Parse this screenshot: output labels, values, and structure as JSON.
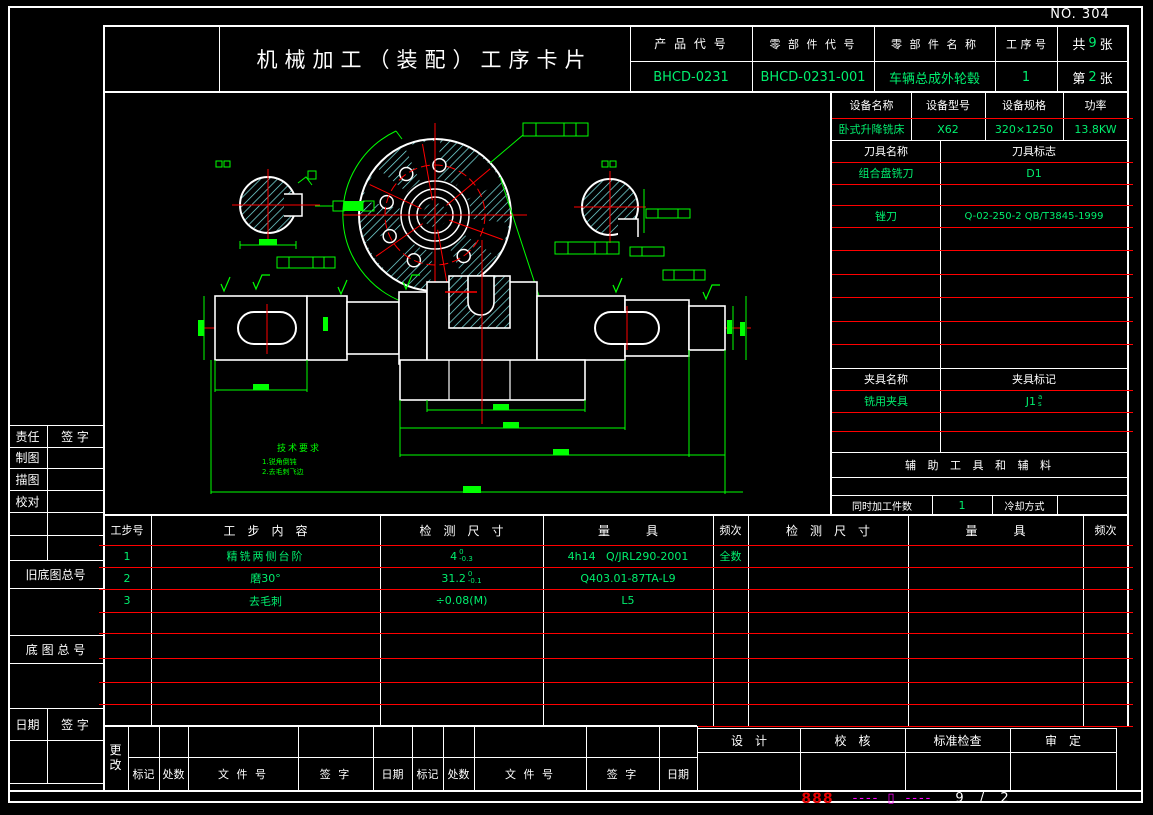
{
  "page": {
    "no": "NO. 304",
    "footer": {
      "code": "888",
      "dash_l": "----",
      "sym": "▯",
      "dash_r": "----",
      "sheet_ratio": "9 / 2"
    }
  },
  "header": {
    "title": "机械加工（装配）工序卡片",
    "product_code_label": "产 品 代 号",
    "part_code_label": "零 部 件 代 号",
    "part_name_label": "零 部 件 名 称",
    "process_no_label": "工 序 号",
    "total_prefix": "共",
    "total_pages": "9",
    "total_suffix": "张",
    "sheet_prefix": "第",
    "sheet_no": "2",
    "sheet_suffix": "张",
    "product_code": "BHCD-0231",
    "part_code": "BHCD-0231-001",
    "part_name": "车辆总成外轮毂",
    "process_no": "1"
  },
  "equipment": {
    "name_label": "设备名称",
    "model_label": "设备型号",
    "spec_label": "设备规格",
    "power_label": "功率",
    "name": "卧式升降铣床",
    "model": "X62",
    "spec": "320×1250",
    "power": "13.8KW"
  },
  "tools": {
    "name_label": "刀具名称",
    "mark_label": "刀具标志",
    "row1_name": "组合盘铣刀",
    "row1_mark": "D1",
    "row2_name": "锉刀",
    "row2_mark": "Q-02-250-2 QB/T3845-1999"
  },
  "fixtures": {
    "name_label": "夹具名称",
    "mark_label": "夹具标记",
    "name": "铣用夹具",
    "mark": "J1",
    "mark_sup": "a",
    "mark_sub": "s"
  },
  "aux_header": "辅 助 工 具 和 辅 料",
  "simul": {
    "label": "同时加工件数",
    "value": "1",
    "cooling_label": "冷却方式",
    "cooling_value": ""
  },
  "process": {
    "h_step_no": "工步号",
    "h_content": "工　步　内　容",
    "h_dim": "检　测　尺　寸",
    "h_gauge": "量　　　具",
    "h_freq": "频次",
    "rows": [
      {
        "no": "1",
        "content": "精铣两侧台阶",
        "dim": "4",
        "sup": "0",
        "sub": "-0.3",
        "gauge": "4h14   Q/JRL290-2001",
        "freq": "全数"
      },
      {
        "no": "2",
        "content": "磨30°",
        "dim": "31.2",
        "sup": "0",
        "sub": "-0.1",
        "gauge": "Q403.01-87TA-L9",
        "freq": ""
      },
      {
        "no": "3",
        "content": "去毛刺",
        "dim": "÷0.08(M)",
        "sup": "",
        "sub": "",
        "gauge": "L5",
        "freq": ""
      }
    ]
  },
  "sidebar": {
    "resp": "责任",
    "sign": "签  字",
    "draft": "制图",
    "trace": "描图",
    "proof": "校对",
    "old_base_no": "旧底图总号",
    "base_no": "底 图 总 号",
    "date": "日期",
    "sign2": "签  字"
  },
  "revision": {
    "change_top": "更",
    "change_bottom": "改",
    "mark1": "标记",
    "count1": "处数",
    "file1": "文 件 号",
    "sign1": "签   字",
    "date1": "日期",
    "mark2": "标记",
    "count2": "处数",
    "file2": "文 件 号",
    "sign2": "签   字",
    "date2": "日期"
  },
  "approval": {
    "design": "设　计",
    "check": "校　核",
    "std": "标准检查",
    "audit": "审　定"
  },
  "drawing": {
    "tech_title": "技术要求",
    "note1": "1.锐角倒钝",
    "note2": "2.去毛刺飞边"
  },
  "colors": {
    "value_green": "#00ef6e",
    "dim_green": "#00ff00",
    "line_red": "#ff0000",
    "hatch_cyan": "#7fe8e8",
    "magenta": "#ff00ff",
    "footer_red": "#e60000",
    "white": "#ffffff"
  }
}
